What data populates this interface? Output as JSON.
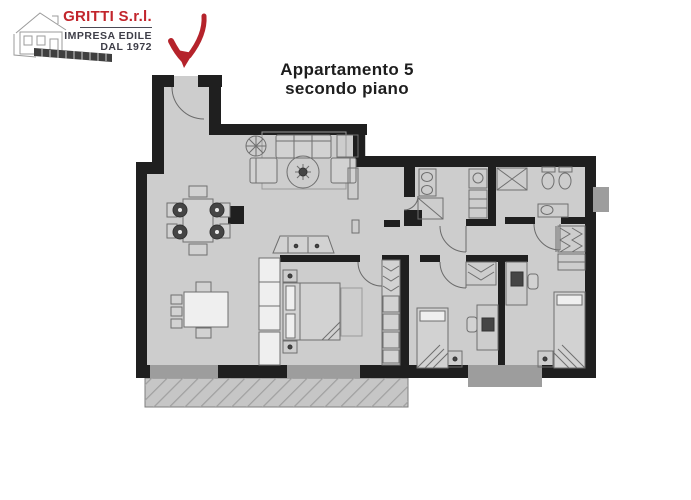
{
  "logo": {
    "company": "GRITTI S.r.l.",
    "tagline_line1": "IMPRESA EDILE",
    "tagline_line2": "DAL 1972",
    "company_color": "#c2252c",
    "tagline_color": "#3e3e48"
  },
  "title": {
    "line1": "Appartamento 5",
    "line2": "secondo piano",
    "color": "#1d1d1d"
  },
  "floor_plan": {
    "wall_color": "#1f1f1f",
    "floor_color": "#cdcdcd",
    "window_color": "#9d9d9d",
    "balcony_color": "#c6c6c6",
    "furniture_color": "#6f6f6f",
    "arrow_color": "#b5232b"
  }
}
